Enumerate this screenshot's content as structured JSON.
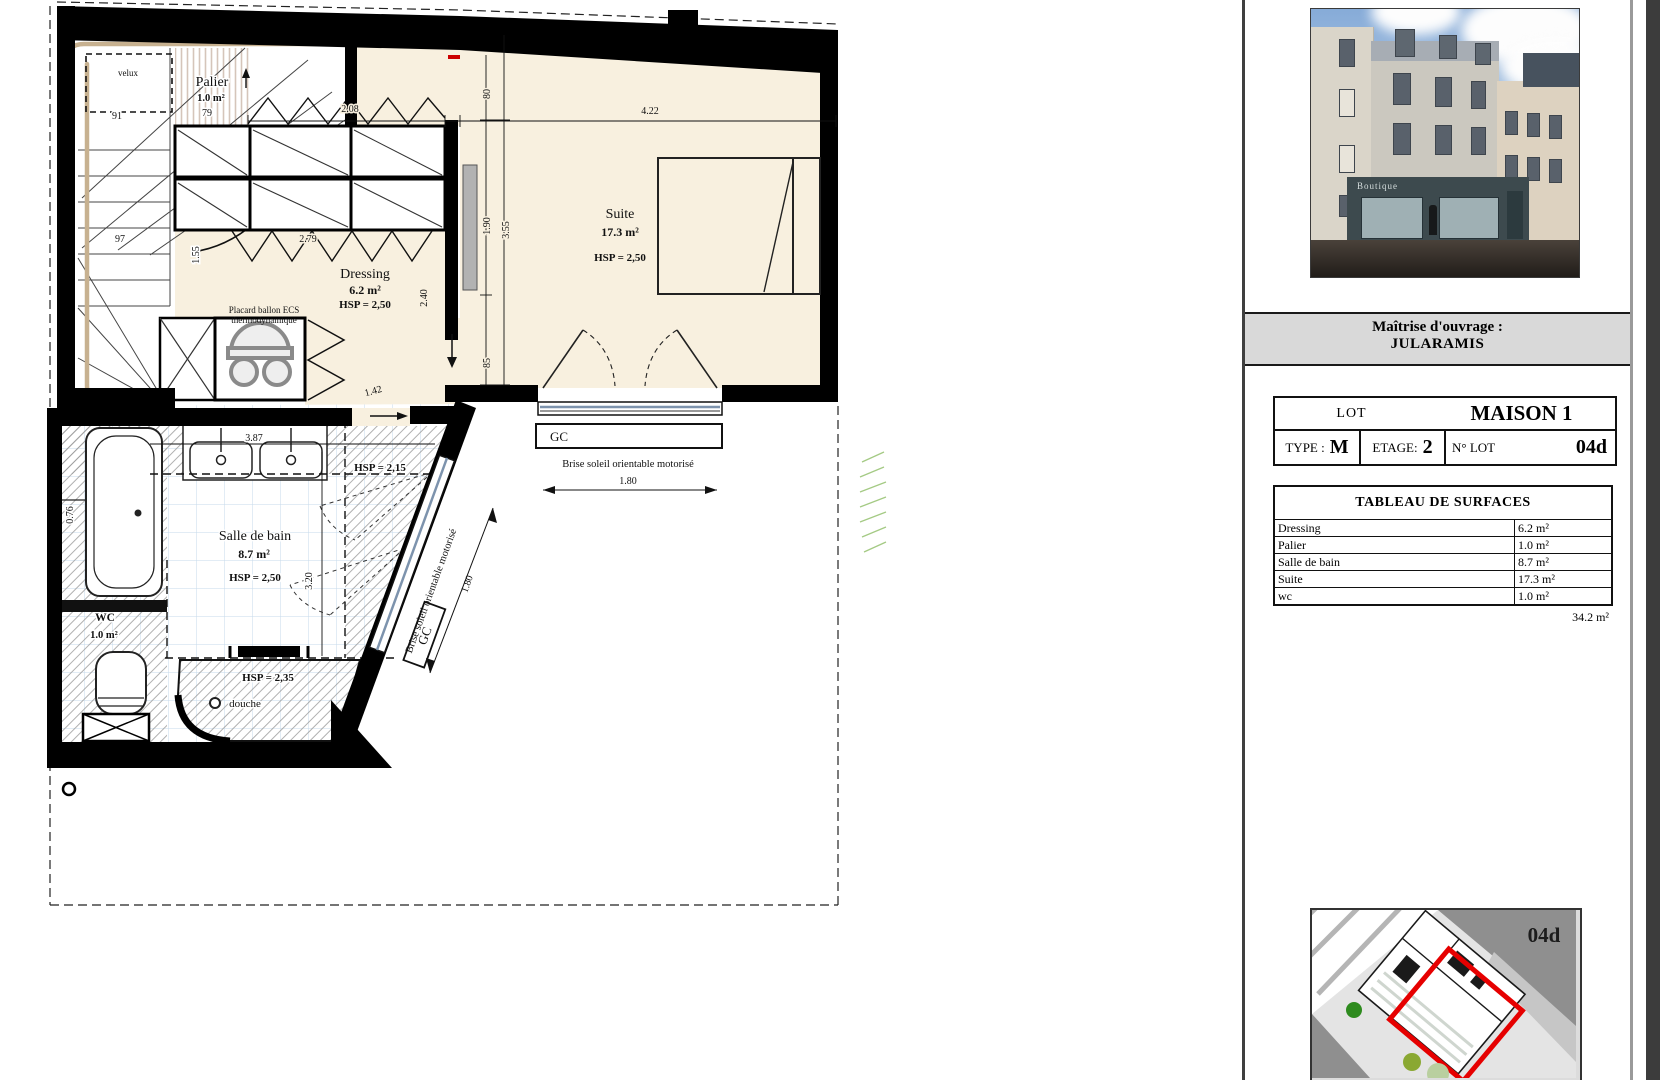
{
  "colors": {
    "wall": "#000000",
    "room_cream": "#f8f0df",
    "tile_blue": "#c6daeb",
    "rail_tan": "#c7b190",
    "lot_red": "#e60000",
    "band_gray": "#d9d9d9"
  },
  "plan": {
    "rooms": {
      "palier": {
        "name": "Palier",
        "area": "1.0 m²",
        "dim": "79"
      },
      "dressing": {
        "name": "Dressing",
        "area": "6.2 m²",
        "hsp": "HSP = 2,50"
      },
      "suite": {
        "name": "Suite",
        "area": "17.3 m²",
        "hsp": "HSP = 2,50"
      },
      "salle_de_bain": {
        "name": "Salle de bain",
        "area": "8.7 m²",
        "hsp": "HSP = 2,50"
      },
      "wc": {
        "name": "WC",
        "area": "1.0 m²"
      }
    },
    "annotations": {
      "velux": "velux",
      "placard_line1": "Placard ballon ECS",
      "placard_line2": "thermodynamique",
      "hsp_215": "HSP = 2,15",
      "hsp_235": "HSP = 2,35",
      "douche": "douche",
      "gc": "GC",
      "brise": "Brise soleil orientable motorisé"
    },
    "dimensions": {
      "d208": "2.08",
      "d422": "4.22",
      "d80": "80",
      "d190": "1.90",
      "d355": "3.55",
      "d85": "85",
      "d279": "2.79",
      "d155": "1.55",
      "d240": "2.40",
      "d142": "1.42",
      "d387": "3.87",
      "d320": "3.20",
      "d076": "0.76",
      "d180": "1.80",
      "s91": "91",
      "s97": "97"
    }
  },
  "panel": {
    "photo": {
      "sign": "Boutique"
    },
    "ouvrage_label": "Maîtrise d'ouvrage :",
    "ouvrage_name": "JULARAMIS",
    "lot_table": {
      "lot_label": "LOT",
      "lot_value": "MAISON 1",
      "type_label": "TYPE :",
      "type_value": "M",
      "etage_label": "ETAGE:",
      "etage_value": "2",
      "nlot_label": "N° LOT",
      "nlot_value": "04d"
    },
    "surfaces": {
      "title": "TABLEAU DE SURFACES",
      "rows": [
        {
          "label": "Dressing",
          "value": "6.2 m²"
        },
        {
          "label": "Palier",
          "value": "1.0 m²"
        },
        {
          "label": "Salle de bain",
          "value": "8.7 m²"
        },
        {
          "label": "Suite",
          "value": "17.3 m²"
        },
        {
          "label": "wc",
          "value": "1.0 m²"
        }
      ],
      "total": "34.2 m²"
    },
    "siteplan_tag": "04d"
  }
}
